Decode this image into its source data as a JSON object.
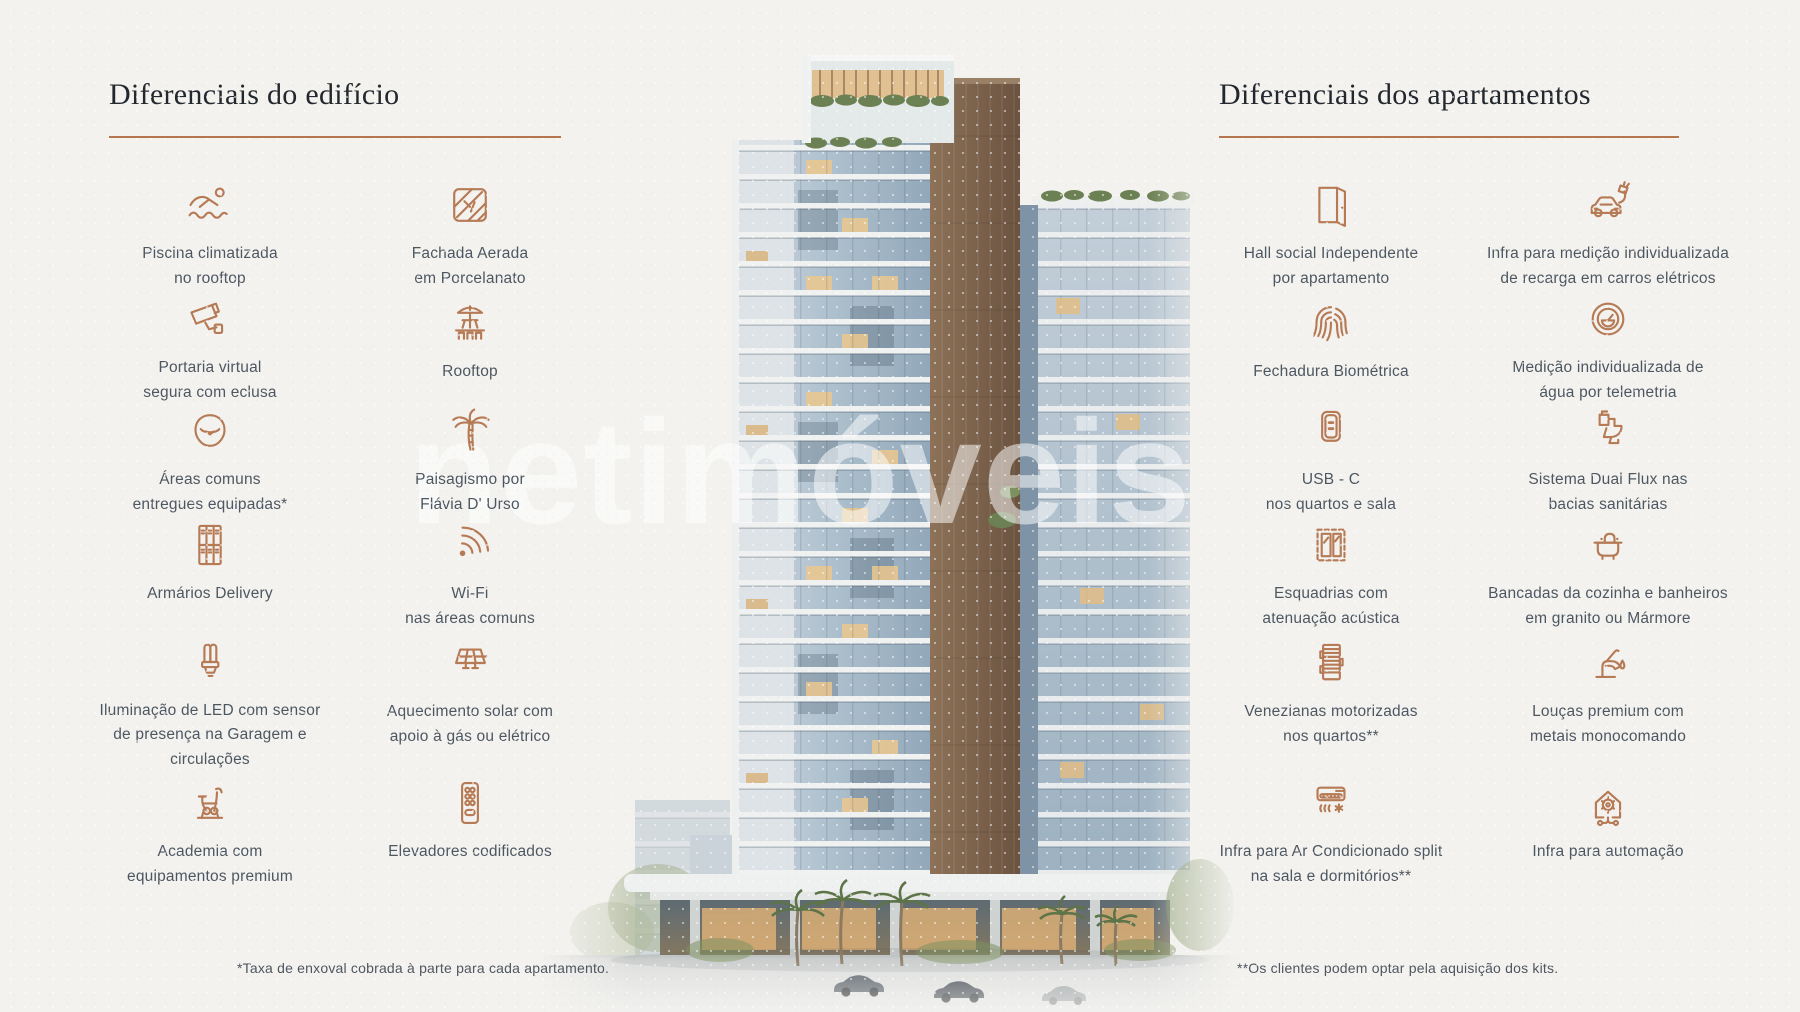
{
  "colors": {
    "accent": "#b5764d",
    "icon": "#b67a55",
    "title": "#23282e",
    "text": "#4d5761",
    "paper": "#f3f2ef"
  },
  "watermark": "netimóveis",
  "left_panel": {
    "title": "Diferenciais do edifício",
    "footnote": "*Taxa de enxoval cobrada à parte para cada apartamento.",
    "features": [
      {
        "icon": "swimmer-icon",
        "label": "Piscina climatizada\nno rooftop"
      },
      {
        "icon": "tiles-icon",
        "label": "Fachada Aerada\nem Porcelanato"
      },
      {
        "icon": "cctv-icon",
        "label": "Portaria virtual\nsegura com eclusa"
      },
      {
        "icon": "rooftop-icon",
        "label": "Rooftop"
      },
      {
        "icon": "beanbag-icon",
        "label": "Áreas comuns\nentregues equipadas*"
      },
      {
        "icon": "palm-tree-icon",
        "label": "Paisagismo por\nFlávia D' Urso"
      },
      {
        "icon": "lockers-icon",
        "label": "Armários Delivery"
      },
      {
        "icon": "wifi-icon",
        "label": "Wi-Fi\nnas áreas comuns"
      },
      {
        "icon": "led-bulb-icon",
        "label": "Iluminação de LED com sensor\nde presença na Garagem e\ncirculações"
      },
      {
        "icon": "solar-panel-icon",
        "label": "Aquecimento solar com\napoio à gás ou elétrico"
      },
      {
        "icon": "exercise-bike-icon",
        "label": "Academia com\nequipamentos premium"
      },
      {
        "icon": "elevator-keypad-icon",
        "label": "Elevadores codificados"
      }
    ]
  },
  "right_panel": {
    "title": "Diferenciais dos apartamentos",
    "footnote": "**Os clientes podem optar pela aquisição dos kits.",
    "features": [
      {
        "icon": "open-door-icon",
        "label": "Hall social Independente\npor apartamento"
      },
      {
        "icon": "ev-car-icon",
        "label": "Infra para medição individualizada\nde recarga em carros elétricos"
      },
      {
        "icon": "fingerprint-icon",
        "label": "Fechadura Biométrica"
      },
      {
        "icon": "water-meter-icon",
        "label": "Medição individualizada de\nágua por telemetria"
      },
      {
        "icon": "usb-outlet-icon",
        "label": "USB - C\nnos quartos e sala"
      },
      {
        "icon": "toilet-icon",
        "label": "Sistema Dual Flux nas\nbacias sanitárias"
      },
      {
        "icon": "window-frame-icon",
        "label": "Esquadrias com\natenuação acústica"
      },
      {
        "icon": "sink-icon",
        "label": "Bancadas da cozinha e banheiros\nem granito ou Mármore"
      },
      {
        "icon": "blinds-icon",
        "label": "Venezianas motorizadas\nnos quartos**"
      },
      {
        "icon": "faucet-icon",
        "label": "Louças premium com\nmetais monocomando"
      },
      {
        "icon": "ac-split-icon",
        "label": "Infra para Ar Condicionado split\nna sala e dormitórios**"
      },
      {
        "icon": "home-automation-icon",
        "label": "Infra para automação"
      }
    ]
  }
}
